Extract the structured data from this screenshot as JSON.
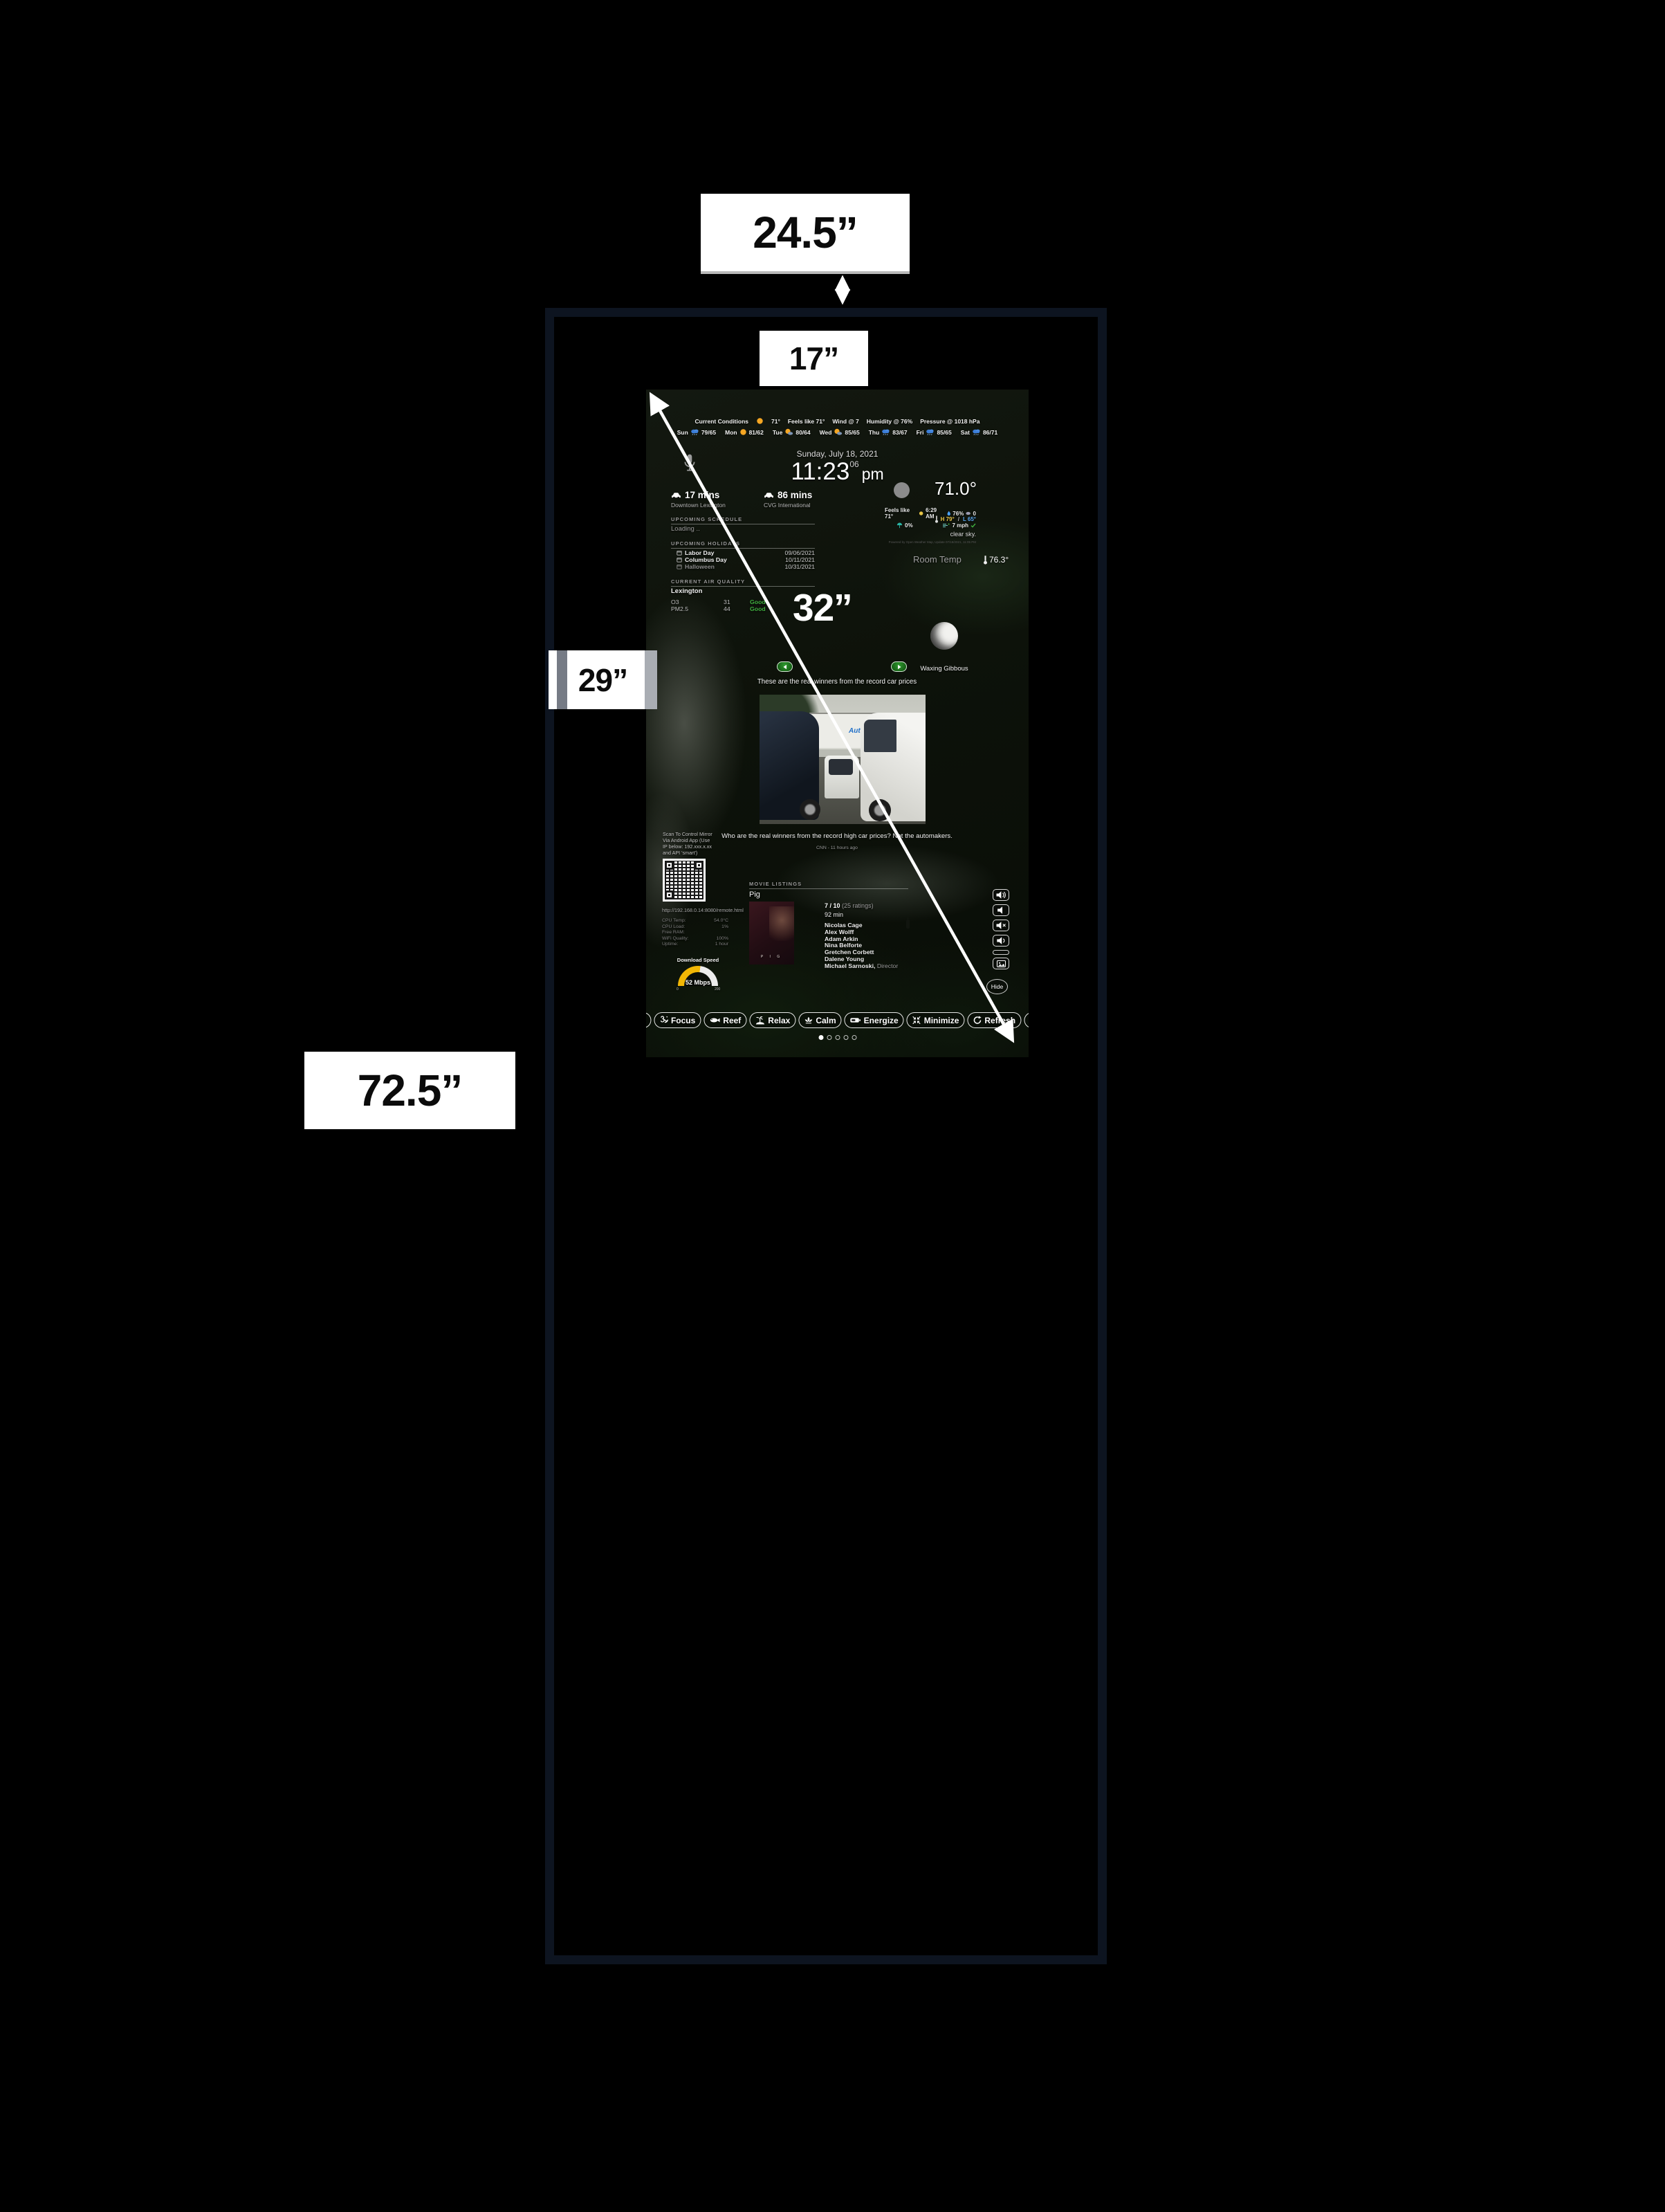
{
  "dimensions": {
    "depth": "24.5”",
    "screen_width": "17”",
    "screen_diagonal": "32”",
    "screen_height": "29”",
    "total_height": "72.5”"
  },
  "colors": {
    "frame_border": "#0d1420",
    "good_green": "#3fae3f",
    "nav_green": "#1b7a1b",
    "gauge_yellow": "#f2b705",
    "autonation_blue": "#2170c8"
  },
  "screen": {
    "conditions_bar": {
      "title": "Current Conditions",
      "temp": "71°",
      "feels": "Feels like 71°",
      "wind": "Wind @ 7",
      "humidity": "Humidity @ 76%",
      "pressure": "Pressure @ 1018 hPa"
    },
    "forecast": [
      {
        "day": "Sun",
        "icon": "rain",
        "temps": "79/65"
      },
      {
        "day": "Mon",
        "icon": "sun",
        "temps": "81/62"
      },
      {
        "day": "Tue",
        "icon": "partly-cloudy",
        "temps": "80/64"
      },
      {
        "day": "Wed",
        "icon": "partly-cloudy",
        "temps": "85/65"
      },
      {
        "day": "Thu",
        "icon": "rain",
        "temps": "83/67"
      },
      {
        "day": "Fri",
        "icon": "rain",
        "temps": "85/65"
      },
      {
        "day": "Sat",
        "icon": "rain",
        "temps": "86/71"
      }
    ],
    "clock": {
      "date": "Sunday, July 18, 2021",
      "time": "11:23",
      "seconds": "06",
      "meridiem": "pm"
    },
    "traffic": [
      {
        "duration": "17 mins",
        "destination": "Downtown Lexington"
      },
      {
        "duration": "86 mins",
        "destination": "CVG International"
      }
    ],
    "schedule": {
      "header": "UPCOMING SCHEDULE",
      "status": "Loading .."
    },
    "holidays": {
      "header": "UPCOMING HOLIDAYS",
      "items": [
        {
          "name": "Labor Day",
          "date": "09/06/2021"
        },
        {
          "name": "Columbus Day",
          "date": "10/11/2021"
        },
        {
          "name": "Halloween",
          "date": "10/31/2021"
        }
      ]
    },
    "air_quality": {
      "header": "CURRENT AIR QUALITY",
      "city": "Lexington",
      "rows": [
        {
          "pollutant": "O3",
          "value": "31",
          "status": "Good"
        },
        {
          "pollutant": "PM2.5",
          "value": "44",
          "status": "Good"
        }
      ]
    },
    "weather": {
      "temp": "71.0°",
      "feels": "Feels like 71°",
      "sunrise": "6:29 AM",
      "humidity": "76%",
      "cloud_cover": "0",
      "high": "H 79°",
      "hl_sep": "/",
      "low": "L 65°",
      "precip": "0%",
      "wind_speed": "7 mph",
      "summary": "clear sky.",
      "attribution": "Powered by Open Weather Map, Update 07/18/2021, 11:05 PM"
    },
    "room_temp": {
      "label": "Room Temp",
      "value": "76.3°"
    },
    "moon": {
      "phase": "Waxing Gibbous"
    },
    "news": {
      "headline": "These are the real winners from the record car prices",
      "image_sign": "AutoNation",
      "caption": "Who are the real winners from the record high car prices? Not the automakers.",
      "source": "CNN - 11 hours ago"
    },
    "remote": {
      "note_line1": "Scan To Control Mirror",
      "note_line2": "Via Android App (Use",
      "note_line3": "IP below: 192.xxx.x.xx",
      "note_line4": "and API 'smart')",
      "url": "http://192.168.0.14:8080/remote.html"
    },
    "system_stats": [
      {
        "label": "CPU Temp:",
        "value": "54.0°C"
      },
      {
        "label": "CPU Load:",
        "value": "1%"
      },
      {
        "label": "Free RAM:",
        "value": ""
      },
      {
        "label": "WiFi Quality:",
        "value": "100%"
      },
      {
        "label": "Uptime:",
        "value": "1 hour"
      }
    ],
    "download_speed": {
      "label": "Download Speed",
      "value": "52 Mbps",
      "min": "0",
      "max": "200"
    },
    "movies": {
      "header": "MOVIE LISTINGS",
      "title": "Pig",
      "poster_text": "P I G",
      "rating": "7 / 10",
      "rating_count": "(25 ratings)",
      "runtime": "92 min",
      "cast": [
        "Nicolas Cage",
        "Alex Wolff",
        "Adam Arkin",
        "Nina Belforte",
        "Gretchen Corbett",
        "Dalene Young",
        "Michael Sarnoski,"
      ],
      "director_label": "Director"
    },
    "side_controls": {
      "hide_label": "Hide"
    },
    "toolbar": {
      "items": [
        {
          "label": "Focus",
          "icon": "om"
        },
        {
          "label": "Reef",
          "icon": "fish"
        },
        {
          "label": "Relax",
          "icon": "palm"
        },
        {
          "label": "Calm",
          "icon": "lotus"
        },
        {
          "label": "Energize",
          "icon": "battery"
        },
        {
          "label": "Minimize",
          "icon": "arrows-in"
        },
        {
          "label": "Refresh",
          "icon": "refresh"
        }
      ]
    },
    "pagination": {
      "total": 5,
      "active": 1
    }
  }
}
